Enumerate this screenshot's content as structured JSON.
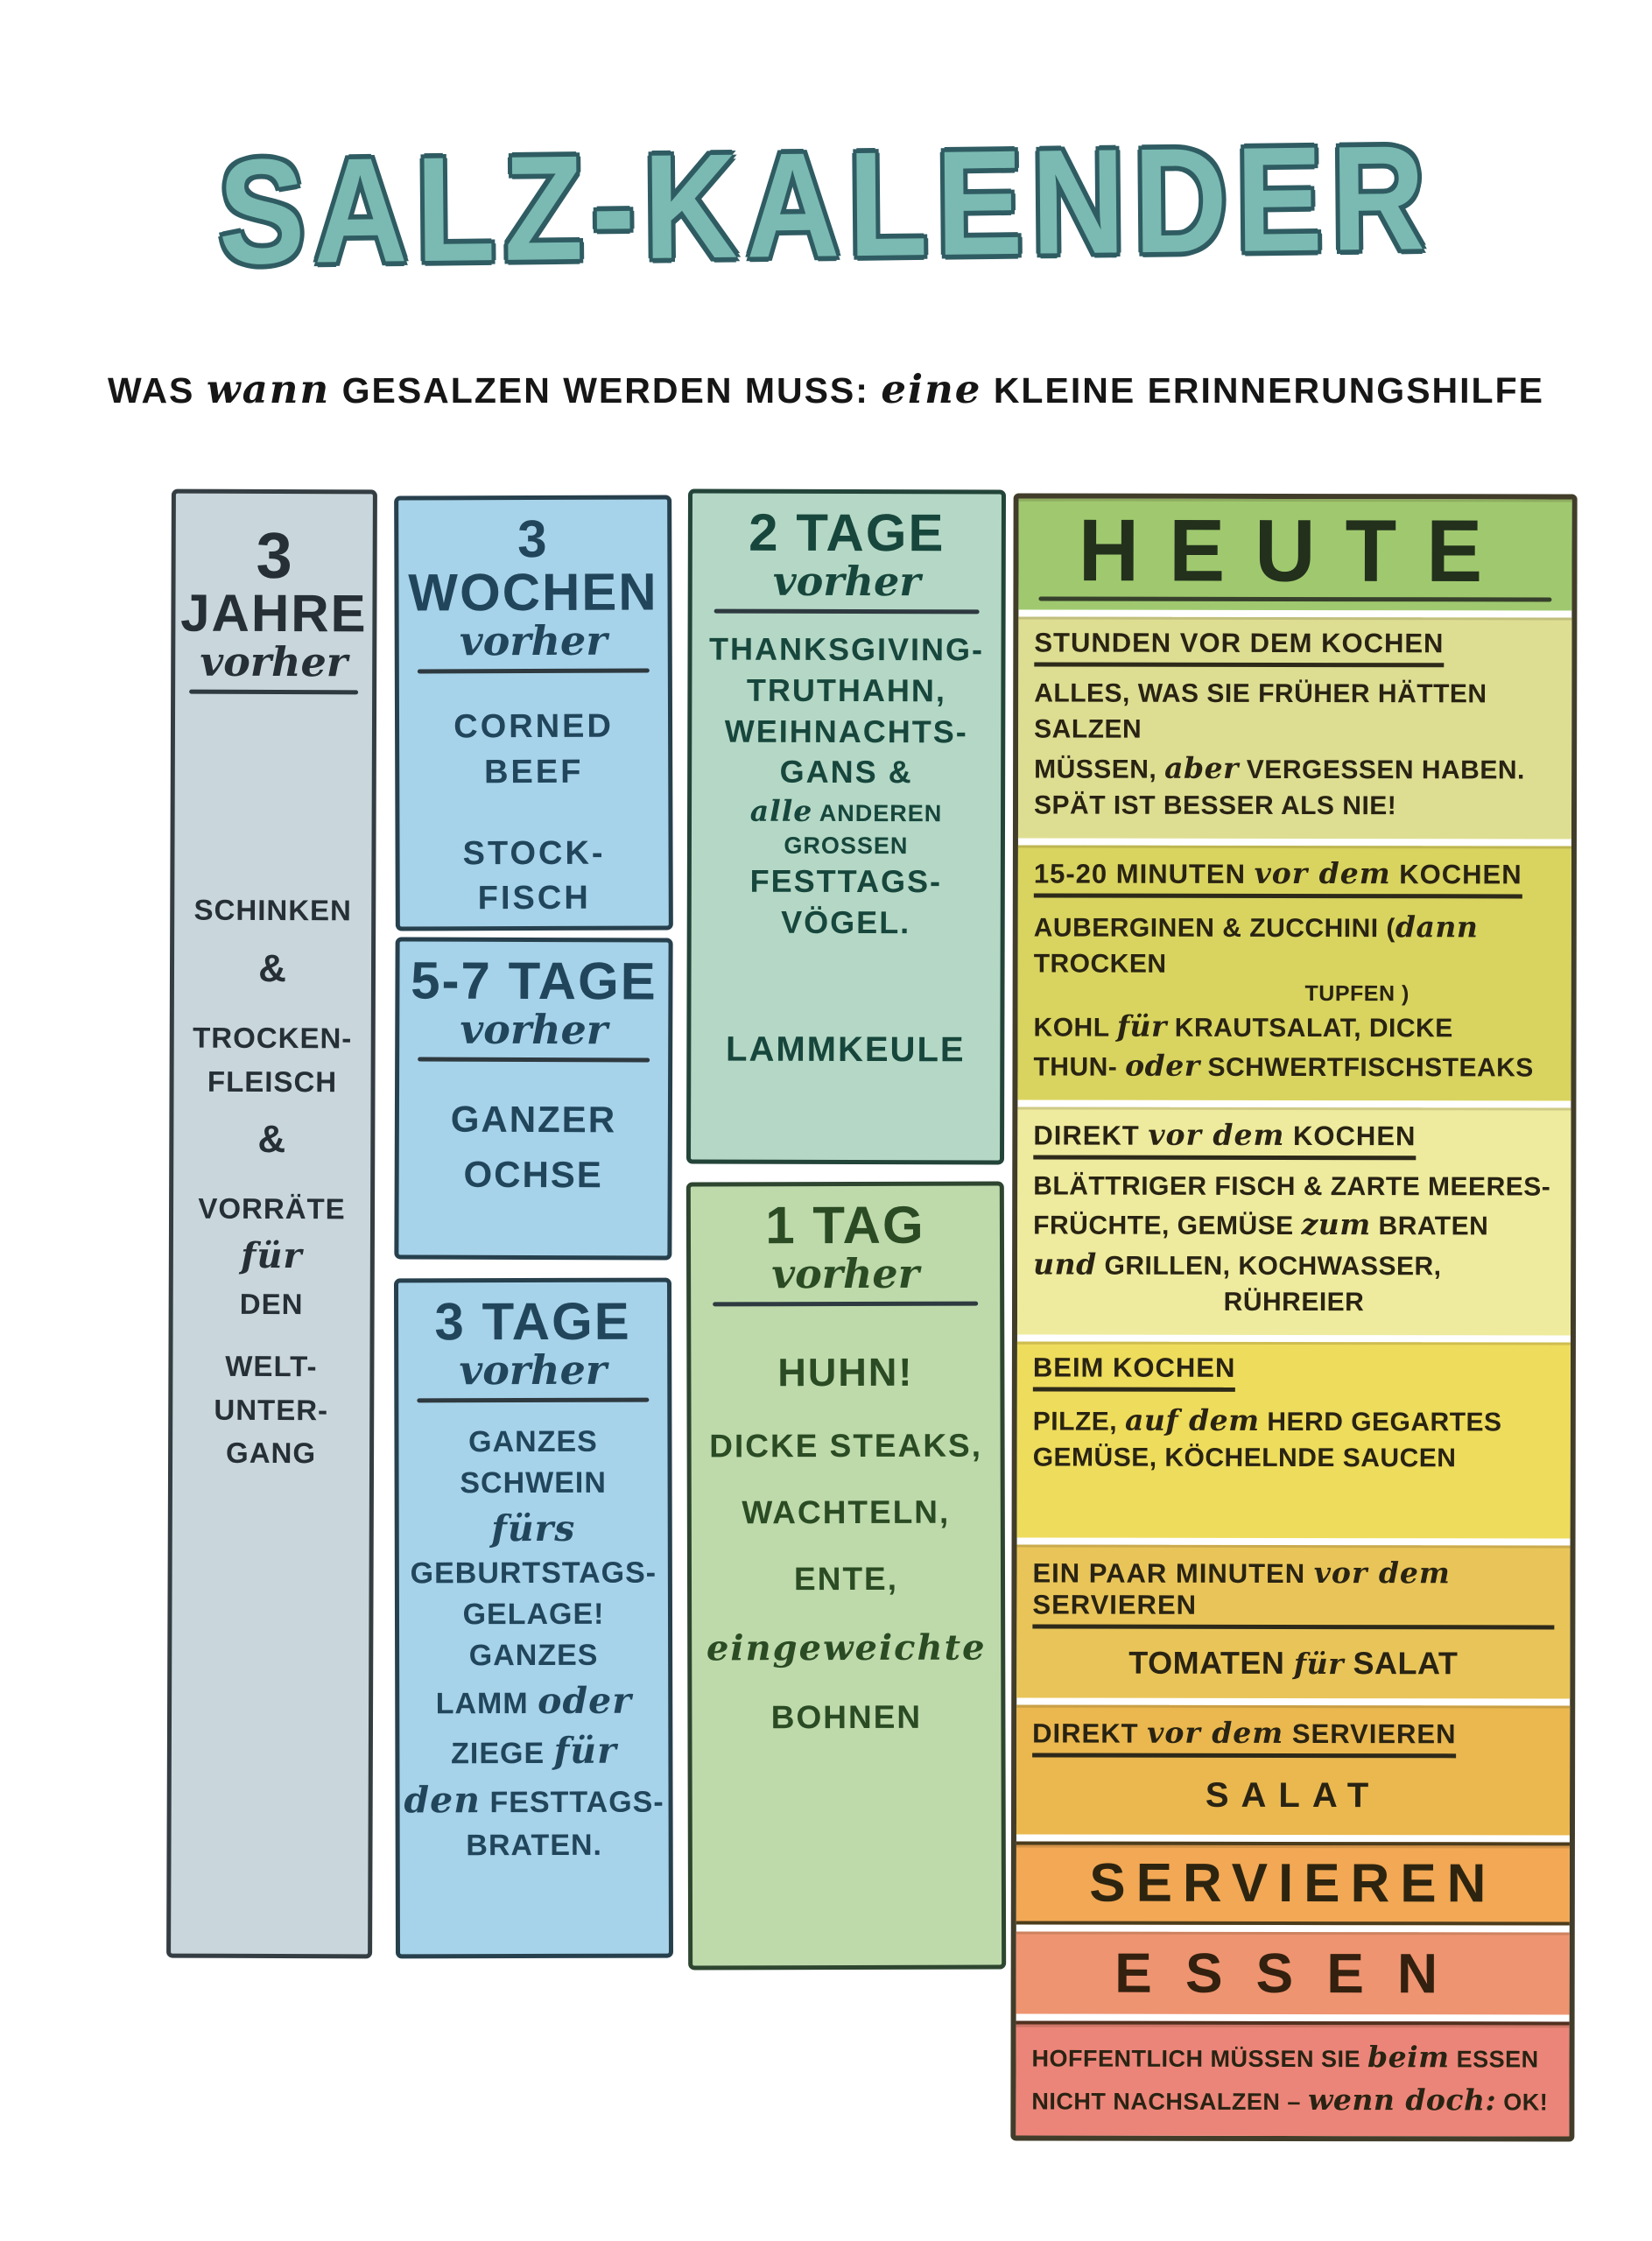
{
  "title": "SALZ-KALENDER",
  "subtitle": {
    "p0": "WAS",
    "s0": "wann",
    "p1": "GESALZEN WERDEN MUSS:",
    "s1": "eine",
    "p2": "KLEINE ERINNERUNGSHILFE"
  },
  "col_jahre": {
    "num": "3",
    "unit": "JAHRE",
    "when": "vorher",
    "lines": [
      "SCHINKEN",
      "&",
      "TROCKEN-",
      "FLEISCH",
      "&",
      "VORRÄTE",
      "für",
      "DEN",
      "WELT-",
      "UNTER-",
      "GANG"
    ]
  },
  "box_wochen": {
    "header": "3 WOCHEN",
    "when": "vorher",
    "lines": [
      "CORNED",
      "BEEF",
      "STOCK-",
      "FISCH"
    ]
  },
  "box_tage57": {
    "header": "5-7 TAGE",
    "when": "vorher",
    "lines": [
      "GANZER",
      "OCHSE"
    ]
  },
  "box_tage3": {
    "header": "3 TAGE",
    "when": "vorher",
    "l0": "GANZES",
    "l1": "SCHWEIN",
    "l2": "fürs",
    "l3": "GEBURTSTAGS-",
    "l4": "GELAGE!",
    "l5": "GANZES",
    "l6a": "LAMM",
    "l6b": "oder",
    "l7a": "ZIEGE",
    "l7b": "für",
    "l8a": "den",
    "l8b": "FESTTAGS-",
    "l9": "BRATEN."
  },
  "box_tage2": {
    "header": "2 TAGE",
    "when": "vorher",
    "l0": "THANKSGIVING-",
    "l1": "TRUTHAHN,",
    "l2": "WEIHNACHTS-",
    "l3": "GANS &",
    "l4a": "alle",
    "l4b": "ANDEREN GROSSEN",
    "l5": "FESTTAGS-",
    "l6": "VÖGEL.",
    "l7": "LAMMKEULE"
  },
  "box_tag1": {
    "header": "1 TAG",
    "when": "vorher",
    "l0": "HUHN!",
    "l1": "DICKE STEAKS,",
    "l2": "WACHTELN,",
    "l3": "ENTE,",
    "l4": "eingeweichte",
    "l5": "BOHNEN"
  },
  "heute": {
    "header": "HEUTE",
    "s1": {
      "heading": "STUNDEN VOR DEM KOCHEN",
      "b0": "ALLES, WAS SIE FRÜHER HÄTTEN SALZEN",
      "b1a": "MÜSSEN,",
      "b1b": "aber",
      "b1c": "VERGESSEN HABEN.",
      "b2": "SPÄT IST BESSER ALS NIE!"
    },
    "s2": {
      "h0": "15-20 MINUTEN",
      "h1": "vor dem",
      "h2": "KOCHEN",
      "b0a": "AUBERGINEN & ZUCCHINI (",
      "b0b": "dann",
      "b0c": "TROCKEN",
      "b1": "TUPFEN )",
      "b2a": "KOHL",
      "b2b": "für",
      "b2c": "KRAUTSALAT, DICKE",
      "b3a": "THUN-",
      "b3b": "oder",
      "b3c": "SCHWERTFISCHSTEAKS"
    },
    "s3": {
      "h0": "DIREKT",
      "h1": "vor dem",
      "h2": "KOCHEN",
      "b0": "BLÄTTRIGER FISCH & ZARTE MEERES-",
      "b1a": "FRÜCHTE, GEMÜSE",
      "b1b": "zum",
      "b1c": "BRATEN",
      "b2a": "und",
      "b2b": "GRILLEN, KOCHWASSER,",
      "b3": "RÜHREIER"
    },
    "s4": {
      "heading": "BEIM KOCHEN",
      "b0a": "PILZE,",
      "b0b": "auf dem",
      "b0c": "HERD GEGARTES",
      "b1": "GEMÜSE, KÖCHELNDE SAUCEN"
    },
    "s5": {
      "h0": "EIN PAAR MINUTEN",
      "h1": "vor dem",
      "h2": "SERVIEREN",
      "b0a": "TOMATEN",
      "b0b": "für",
      "b0c": "SALAT"
    },
    "s6": {
      "h0": "DIREKT",
      "h1": "vor dem",
      "h2": "SERVIEREN",
      "b0": "SALAT"
    },
    "servieren": "SERVIEREN",
    "essen": "ESSEN",
    "footer": {
      "l0a": "HOFFENTLICH MÜSSEN SIE",
      "l0b": "beim",
      "l0c": "ESSEN",
      "l1a": "NICHT NACHSALZEN –",
      "l1b": "wenn doch:",
      "l1c": "OK!"
    }
  },
  "colors": {
    "title_teal": "#7abab2",
    "title_outline": "#2f5c62",
    "jahre_bg": "#c9d7dc",
    "blue_bg": "#a7d3ea",
    "tage2_bg": "#b5d8c6",
    "tag1_bg": "#bedaab",
    "heute_header": "#a0c96f",
    "stunden_band": "#dede93",
    "minuten_band": "#d9d45f",
    "direkt_kochen_band": "#eeeb9e",
    "beim_kochen_band": "#eedc5c",
    "paar_minuten_band": "#e9c559",
    "direkt_servieren_band": "#eab84f",
    "servieren_band": "#f2a854",
    "essen_band": "#ee9470",
    "footer_band": "#ec8579"
  }
}
